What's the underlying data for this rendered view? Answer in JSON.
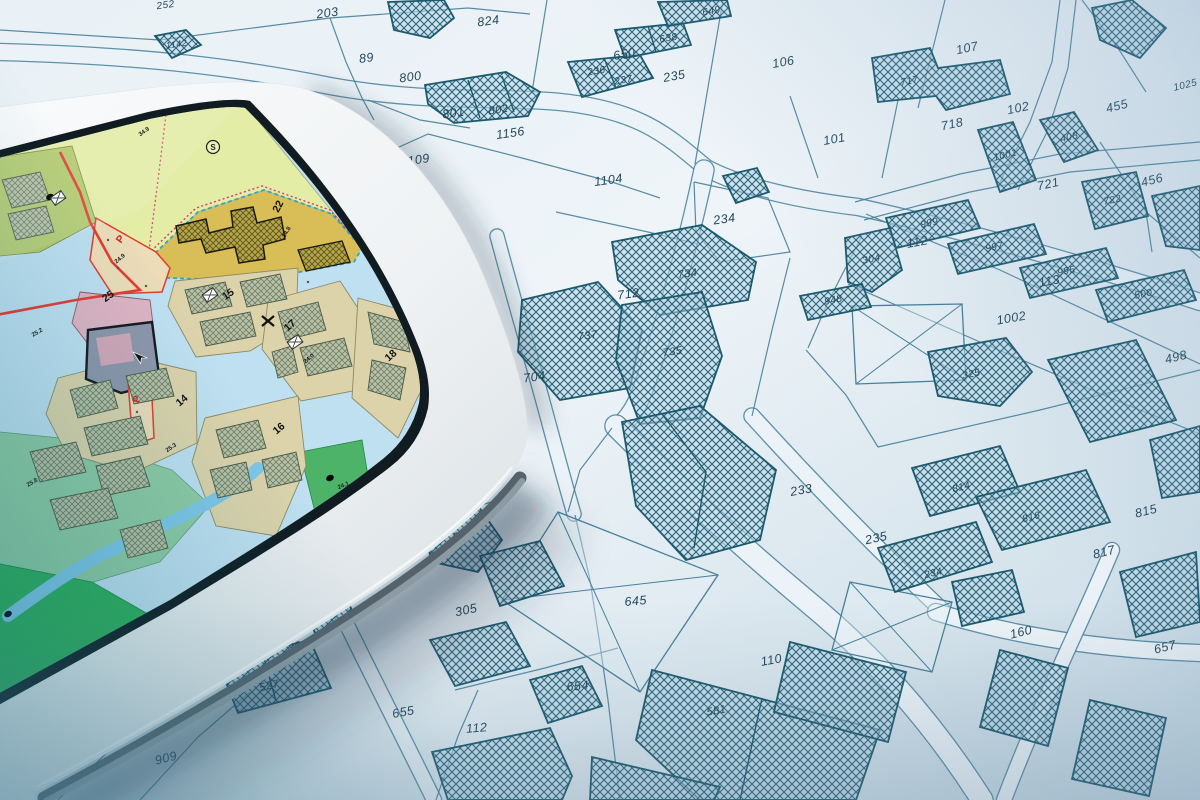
{
  "colors": {
    "paper_light": "#eef4f8",
    "paper_shade": "#c6d9e4",
    "line": "#47809a",
    "hatch_line": "#226078",
    "parcel_text": "#24485c",
    "road_fill": "#ecf3f8",
    "tablet_body": "#f5f7f8",
    "screen_water": "#bfe0f1",
    "screen_river": "#7fc7e9",
    "screen_park": "#2fae5a",
    "screen_park_light": "#8fcba4",
    "zone_yellow_green": "#e4eda6",
    "zone_olive": "#b2ca6c",
    "zone_mustard": "#d9bd56",
    "zone_tan": "#dcd3ab",
    "zone_pink": "#dfb4c3",
    "zone_parking": "#ecdcb8",
    "building_dark": "#8e96aa",
    "boundary_red": "#e23c31",
    "dashed_cyan": "#29a8d0"
  },
  "paper_map": {
    "parcel_labels": [
      {
        "t": "252",
        "x": 166,
        "y": 8,
        "r": -8,
        "s": 10
      },
      {
        "t": "203",
        "x": 328,
        "y": 17,
        "r": -8
      },
      {
        "t": "824",
        "x": 489,
        "y": 25,
        "r": -8
      },
      {
        "t": "89",
        "x": 367,
        "y": 62,
        "r": -8
      },
      {
        "t": "800",
        "x": 411,
        "y": 81,
        "r": -8
      },
      {
        "t": "801",
        "x": 454,
        "y": 117,
        "r": -8
      },
      {
        "t": "802",
        "x": 499,
        "y": 113,
        "r": -8,
        "s": 11
      },
      {
        "t": "1156",
        "x": 511,
        "y": 137,
        "r": -8
      },
      {
        "t": "1109",
        "x": 416,
        "y": 164,
        "r": -8
      },
      {
        "t": "1104",
        "x": 609,
        "y": 184,
        "r": -8
      },
      {
        "t": "1142",
        "x": 177,
        "y": 47,
        "r": -8,
        "s": 9
      },
      {
        "t": "650",
        "x": 625,
        "y": 58,
        "r": -10
      },
      {
        "t": "236",
        "x": 597,
        "y": 74,
        "r": -10,
        "s": 10
      },
      {
        "t": "237",
        "x": 624,
        "y": 83,
        "r": -10,
        "s": 10
      },
      {
        "t": "235",
        "x": 675,
        "y": 80,
        "r": -10
      },
      {
        "t": "638",
        "x": 669,
        "y": 41,
        "r": -10,
        "s": 10
      },
      {
        "t": "649",
        "x": 712,
        "y": 14,
        "r": -10,
        "s": 10
      },
      {
        "t": "234",
        "x": 725,
        "y": 223,
        "r": -8
      },
      {
        "t": "106",
        "x": 784,
        "y": 66,
        "r": -10
      },
      {
        "t": "107",
        "x": 968,
        "y": 52,
        "r": -12
      },
      {
        "t": "102",
        "x": 1019,
        "y": 112,
        "r": -12
      },
      {
        "t": "101",
        "x": 835,
        "y": 143,
        "r": -10
      },
      {
        "t": "718",
        "x": 953,
        "y": 128,
        "r": -12
      },
      {
        "t": "717",
        "x": 910,
        "y": 84,
        "r": -12,
        "s": 10
      },
      {
        "t": "455",
        "x": 1118,
        "y": 110,
        "r": -14
      },
      {
        "t": "456",
        "x": 1153,
        "y": 184,
        "r": -14
      },
      {
        "t": "1025",
        "x": 1186,
        "y": 88,
        "r": -14,
        "s": 10
      },
      {
        "t": "408",
        "x": 1070,
        "y": 140,
        "r": -14,
        "s": 10
      },
      {
        "t": "1001",
        "x": 1006,
        "y": 158,
        "r": -14,
        "s": 10
      },
      {
        "t": "721",
        "x": 1049,
        "y": 188,
        "r": -12
      },
      {
        "t": "722",
        "x": 1113,
        "y": 203,
        "r": -12,
        "s": 10
      },
      {
        "t": "999",
        "x": 930,
        "y": 226,
        "r": -12,
        "s": 10
      },
      {
        "t": "997",
        "x": 995,
        "y": 250,
        "r": -12,
        "s": 10
      },
      {
        "t": "995",
        "x": 1067,
        "y": 274,
        "r": -12,
        "s": 10
      },
      {
        "t": "500",
        "x": 1144,
        "y": 297,
        "r": -12,
        "s": 10
      },
      {
        "t": "304",
        "x": 872,
        "y": 262,
        "r": -12,
        "s": 10
      },
      {
        "t": "112",
        "x": 918,
        "y": 246,
        "r": -10
      },
      {
        "t": "113",
        "x": 1050,
        "y": 285,
        "r": -10
      },
      {
        "t": "1002",
        "x": 1012,
        "y": 322,
        "r": -10
      },
      {
        "t": "498",
        "x": 1177,
        "y": 361,
        "r": -14
      },
      {
        "t": "325",
        "x": 972,
        "y": 377,
        "r": -12,
        "s": 10
      },
      {
        "t": "948",
        "x": 834,
        "y": 303,
        "r": -12,
        "s": 10
      },
      {
        "t": "712",
        "x": 629,
        "y": 298,
        "r": -8
      },
      {
        "t": "737",
        "x": 588,
        "y": 339,
        "r": -8,
        "s": 11
      },
      {
        "t": "734",
        "x": 688,
        "y": 277,
        "r": -8,
        "s": 11
      },
      {
        "t": "735",
        "x": 673,
        "y": 355,
        "r": -8,
        "s": 11
      },
      {
        "t": "704",
        "x": 535,
        "y": 381,
        "r": -8
      },
      {
        "t": "233",
        "x": 802,
        "y": 494,
        "r": -10
      },
      {
        "t": "646",
        "x": 463,
        "y": 539,
        "r": -10,
        "s": 11
      },
      {
        "t": "305",
        "x": 467,
        "y": 614,
        "r": -12
      },
      {
        "t": "645",
        "x": 636,
        "y": 605,
        "r": -5
      },
      {
        "t": "654",
        "x": 578,
        "y": 690,
        "r": -5
      },
      {
        "t": "655",
        "x": 404,
        "y": 716,
        "r": -10
      },
      {
        "t": "112",
        "x": 477,
        "y": 732,
        "r": -5
      },
      {
        "t": "303",
        "x": 299,
        "y": 650,
        "r": -12
      },
      {
        "t": "527",
        "x": 270,
        "y": 689,
        "r": -14,
        "s": 11
      },
      {
        "t": "909",
        "x": 167,
        "y": 762,
        "r": -14
      },
      {
        "t": "46",
        "x": 71,
        "y": 771,
        "r": -14,
        "s": 11
      },
      {
        "t": "581",
        "x": 717,
        "y": 714,
        "r": -10,
        "s": 11
      },
      {
        "t": "110",
        "x": 772,
        "y": 664,
        "r": -10
      },
      {
        "t": "235",
        "x": 877,
        "y": 542,
        "r": -12
      },
      {
        "t": "234",
        "x": 934,
        "y": 576,
        "r": -14,
        "s": 10
      },
      {
        "t": "814",
        "x": 962,
        "y": 490,
        "r": -14,
        "s": 10
      },
      {
        "t": "816",
        "x": 1032,
        "y": 520,
        "r": -14,
        "s": 10
      },
      {
        "t": "815",
        "x": 1147,
        "y": 515,
        "r": -14
      },
      {
        "t": "817",
        "x": 1105,
        "y": 556,
        "r": -14
      },
      {
        "t": "160",
        "x": 1022,
        "y": 636,
        "r": -14
      },
      {
        "t": "657",
        "x": 1166,
        "y": 651,
        "r": -14
      }
    ]
  },
  "tablet": {
    "zone_labels": [
      {
        "t": "22",
        "x": 281,
        "y": 208,
        "r": -62
      },
      {
        "t": "25",
        "x": 110,
        "y": 299,
        "r": -35
      },
      {
        "t": "15",
        "x": 230,
        "y": 297,
        "r": -35
      },
      {
        "t": "17",
        "x": 292,
        "y": 328,
        "r": -40
      },
      {
        "t": "18",
        "x": 393,
        "y": 358,
        "r": -42
      },
      {
        "t": "14",
        "x": 184,
        "y": 403,
        "r": -40
      },
      {
        "t": "16",
        "x": 281,
        "y": 431,
        "r": -40
      },
      {
        "t": "P",
        "x": 123,
        "y": 241,
        "r": -55,
        "red": true
      },
      {
        "t": "P",
        "x": 140,
        "y": 400,
        "r": -75,
        "red": true
      }
    ],
    "area_codes": [
      {
        "t": "34.9",
        "x": 145,
        "y": 133,
        "r": -35
      },
      {
        "t": "34.8",
        "x": 288,
        "y": 233,
        "r": -60
      },
      {
        "t": "24.9",
        "x": 121,
        "y": 260,
        "r": -40
      },
      {
        "t": "25.2",
        "x": 38,
        "y": 334,
        "r": -30
      },
      {
        "t": "25.3",
        "x": 172,
        "y": 449,
        "r": -35
      },
      {
        "t": "25.8",
        "x": 33,
        "y": 484,
        "r": -30
      },
      {
        "t": "24.0",
        "x": 310,
        "y": 360,
        "r": -40
      },
      {
        "t": "24.1",
        "x": 344,
        "y": 487,
        "r": -22
      }
    ],
    "symbols": [
      {
        "n": "s-circle",
        "x": 213,
        "y": 147
      },
      {
        "n": "x-mark",
        "x": 268,
        "y": 321
      },
      {
        "n": "cursor",
        "x": 133,
        "y": 352
      },
      {
        "n": "dot",
        "x": 50,
        "y": 197
      },
      {
        "n": "dot",
        "x": 330,
        "y": 478
      },
      {
        "n": "dot",
        "x": 8,
        "y": 614
      },
      {
        "n": "rect-x",
        "x": 210,
        "y": 295
      },
      {
        "n": "rect-x",
        "x": 295,
        "y": 342
      },
      {
        "n": "rect-x",
        "x": 58,
        "y": 198
      }
    ]
  }
}
